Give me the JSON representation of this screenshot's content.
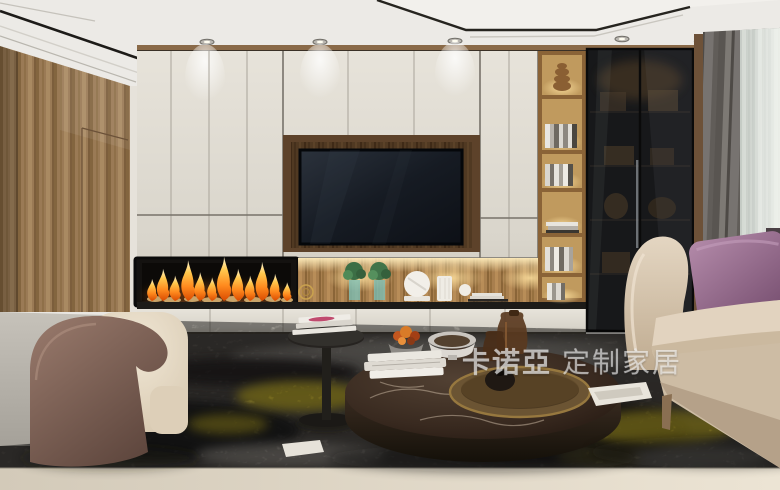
{
  "watermark": {
    "brand": "卡诺亞",
    "suffix": "定制家居",
    "full_text": "卡诺亞 定制家居",
    "color": "#ffffff",
    "opacity": 0.55
  },
  "palette": {
    "ceiling_white": "#ecebe7",
    "cabinet_cream": "#ddd9d0",
    "wood_wall": "#9a7a55",
    "niche_wood_dark": "#6b4c2e",
    "console_wood_lit": "#a87f4e",
    "tv_screen": "#12161d",
    "fireplace_black": "#0e0c0a",
    "flame_orange": "#ff8a1e",
    "flame_yellow": "#ffd45e",
    "glass_cabinet": "#17181a",
    "curtain_gray": "#6e6a66",
    "sheer_curtain": "#ccd3cc",
    "sofa_beige": "#d8c8b4",
    "pillow_purple": "#96688c",
    "rug_dark": "#4d4945",
    "rug_yellow": "#c6b22c",
    "floor_light": "#ded6c6",
    "marble_table": "#38291f",
    "tray_bronze": "#7c6239",
    "armchair_shell": "#87685c",
    "armchair_cushion": "#e7dcc9"
  },
  "scene": {
    "type": "interior-render",
    "room": "living room",
    "objects": [
      "tray ceiling with downlights",
      "wood panel wall with hidden door",
      "cream wall cabinets",
      "recessed TV in wood niche",
      "linear fireplace with flames",
      "lit display niche with vases and plants",
      "open wood bookshelf tower",
      "smoked glass display cabinet",
      "gray curtain and sheer curtain",
      "beige sofa with purple pillow",
      "curved armchair",
      "round marble coffee table with bronze tray",
      "black pedestal side table with magazines",
      "dark mottled rug with yellow accents",
      "light stone floor"
    ]
  }
}
